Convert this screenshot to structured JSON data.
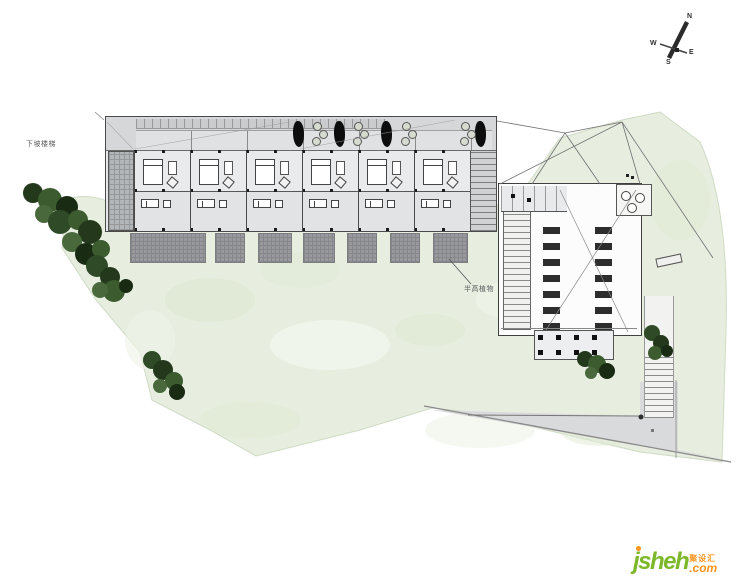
{
  "site": {
    "labels": {
      "downhill_stairs": "下坡楼梯",
      "half_height_plants": "半高植物"
    }
  },
  "compass": {
    "north": "N",
    "south": "S",
    "east": "E",
    "west": "W"
  },
  "watermark": {
    "brand": "jsheh",
    "brand_cn": "聚设汇",
    "tld": ".com"
  },
  "colors": {
    "terrain_green": "#e7eee0",
    "tree_green": "#2f4a26",
    "building_gray": "#e6e7e9",
    "terrace_gray": "#97999c",
    "logo_green": "#7cb829",
    "logo_orange": "#f7941d"
  }
}
